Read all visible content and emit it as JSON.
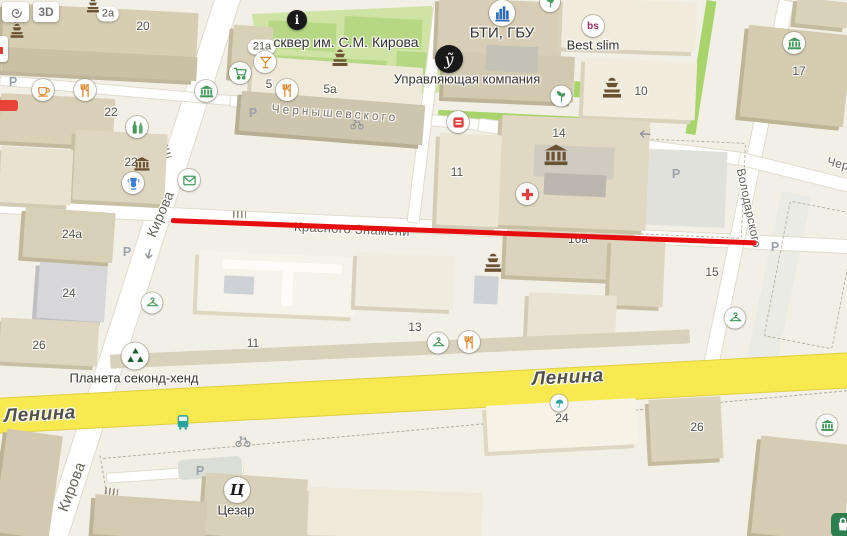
{
  "controls": {
    "tilt_label": "3D",
    "layers_icon": "layers-spiral-icon"
  },
  "colors": {
    "route": "#e60d0d",
    "road_highlight": "#f7e94f",
    "map_background": "#f2efe6"
  },
  "overlay": {
    "route_line": {
      "x": 171,
      "y": 217.5,
      "length": 586,
      "angle_deg": 2.2,
      "color": "#e60d0d"
    }
  },
  "streets": [
    {
      "text": "Кирова",
      "x": 160,
      "y": 214,
      "rot": -67,
      "size": 14
    },
    {
      "text": "Кирова",
      "x": 72,
      "y": 487,
      "rot": -69,
      "size": 15
    },
    {
      "text": "Красного Знамени",
      "x": 352,
      "y": 229,
      "rot": 2.5,
      "size": 13
    },
    {
      "text": "Ленина",
      "x": 40,
      "y": 415,
      "rot": -3,
      "size": 19,
      "major": true
    },
    {
      "text": "Ленина",
      "x": 568,
      "y": 378,
      "rot": -3,
      "size": 19,
      "major": true
    },
    {
      "text": "Володарского",
      "x": 749,
      "y": 208,
      "rot": 78,
      "size": 12
    },
    {
      "text": "Чернышевского",
      "x": 872,
      "y": 172,
      "rot": 14,
      "size": 12
    },
    {
      "text": "Чернышевского",
      "x": 335,
      "y": 113,
      "rot": 4,
      "size": 12,
      "spaced": true
    }
  ],
  "places": [
    {
      "text": "сквер им. С.М. Кирова",
      "x": 346,
      "y": 42,
      "size": 14
    },
    {
      "text": "БТИ, ГБУ",
      "x": 502,
      "y": 33,
      "size": 15
    },
    {
      "text": "Управляющая компания",
      "x": 467,
      "y": 79,
      "size": 13
    },
    {
      "text": "Best slim",
      "x": 593,
      "y": 45,
      "size": 13
    },
    {
      "text": "Планета секонд-хенд",
      "x": 134,
      "y": 378,
      "size": 13
    },
    {
      "text": "Цезар",
      "x": 236,
      "y": 510,
      "size": 13
    }
  ],
  "house_numbers": [
    {
      "text": "2a",
      "x": 108,
      "y": 14,
      "pill": true
    },
    {
      "text": "20",
      "x": 143,
      "y": 26
    },
    {
      "text": "21a",
      "x": 262,
      "y": 47,
      "pill": true
    },
    {
      "text": "5",
      "x": 269,
      "y": 84
    },
    {
      "text": "5a",
      "x": 330,
      "y": 89
    },
    {
      "text": "22",
      "x": 111,
      "y": 112
    },
    {
      "text": "22",
      "x": 131,
      "y": 162
    },
    {
      "text": "10",
      "x": 641,
      "y": 91
    },
    {
      "text": "17",
      "x": 799,
      "y": 71
    },
    {
      "text": "14",
      "x": 559,
      "y": 133
    },
    {
      "text": "11",
      "x": 457,
      "y": 172
    },
    {
      "text": "24a",
      "x": 72,
      "y": 234
    },
    {
      "text": "24",
      "x": 69,
      "y": 293
    },
    {
      "text": "26",
      "x": 39,
      "y": 345
    },
    {
      "text": "16a",
      "x": 578,
      "y": 239
    },
    {
      "text": "15",
      "x": 712,
      "y": 272
    },
    {
      "text": "13",
      "x": 415,
      "y": 327
    },
    {
      "text": "11",
      "x": 253,
      "y": 343
    },
    {
      "text": "24",
      "x": 562,
      "y": 418
    },
    {
      "text": "26",
      "x": 697,
      "y": 427
    }
  ],
  "parking": {
    "label": "Р",
    "positions": [
      [
        13,
        82
      ],
      [
        253,
        113
      ],
      [
        127,
        252
      ],
      [
        676,
        174
      ],
      [
        775,
        247
      ],
      [
        200,
        471
      ]
    ]
  },
  "markers": [
    {
      "name": "info-icon",
      "icon": "text",
      "text": "i",
      "x": 297,
      "y": 20,
      "badge": "black",
      "size": 20,
      "cls": "t-info"
    },
    {
      "name": "fountain-icon",
      "icon": "fountain",
      "x": 340,
      "y": 58,
      "badge": "none",
      "size": 20,
      "color": "brown"
    },
    {
      "name": "fountain-icon",
      "icon": "fountain",
      "x": 93,
      "y": 6,
      "badge": "none",
      "size": 16,
      "color": "brown"
    },
    {
      "name": "fountain-icon",
      "icon": "fountain",
      "x": 17,
      "y": 31,
      "badge": "none",
      "size": 17,
      "color": "brown"
    },
    {
      "name": "bar-icon",
      "icon": "cocktail",
      "x": 265,
      "y": 62,
      "badge": "white",
      "size": 22,
      "color": "orange"
    },
    {
      "name": "supermarket-icon",
      "icon": "cart",
      "x": 240,
      "y": 73,
      "badge": "white",
      "size": 22,
      "color": "green"
    },
    {
      "name": "restaurant-icon",
      "icon": "restaurant",
      "x": 287,
      "y": 90,
      "badge": "white",
      "size": 22,
      "color": "orange"
    },
    {
      "name": "cafe-icon",
      "icon": "cafe",
      "x": 43,
      "y": 90,
      "badge": "white",
      "size": 22,
      "color": "orange"
    },
    {
      "name": "restaurant-icon",
      "icon": "restaurant",
      "x": 85,
      "y": 90,
      "badge": "white",
      "size": 22,
      "color": "orange"
    },
    {
      "name": "museum-icon",
      "icon": "museum",
      "x": 206,
      "y": 91,
      "badge": "white",
      "size": 22,
      "color": "green"
    },
    {
      "name": "pharmacy-icon",
      "icon": "flask",
      "x": 137,
      "y": 127,
      "badge": "white",
      "size": 22,
      "color": "green"
    },
    {
      "name": "museum-icon",
      "icon": "museum",
      "x": 142,
      "y": 164,
      "badge": "none",
      "size": 17,
      "color": "brown"
    },
    {
      "name": "museum-vase-icon",
      "icon": "vase",
      "x": 133,
      "y": 183,
      "badge": "white",
      "size": 22,
      "color": "blue"
    },
    {
      "name": "post-icon",
      "icon": "mail",
      "x": 189,
      "y": 180,
      "badge": "white",
      "size": 22,
      "color": "green"
    },
    {
      "name": "bti-logo-icon",
      "icon": "bti",
      "x": 502,
      "y": 13,
      "badge": "white",
      "size": 26,
      "color": "bti"
    },
    {
      "name": "company-logo-icon",
      "icon": "text",
      "text": "ỹ",
      "x": 449,
      "y": 59,
      "badge": "black",
      "size": 28,
      "cls": "t-uscript"
    },
    {
      "name": "best-slim-logo-icon",
      "icon": "text",
      "text": "bs",
      "x": 593,
      "y": 26,
      "badge": "white",
      "size": 22,
      "cls": "t-bs"
    },
    {
      "name": "eco-leaf-icon",
      "icon": "sprout",
      "x": 561,
      "y": 96,
      "badge": "white",
      "size": 21,
      "color": "green"
    },
    {
      "name": "eco-leaf-icon",
      "icon": "sprout",
      "x": 550,
      "y": 2,
      "badge": "white",
      "size": 20,
      "color": "green"
    },
    {
      "name": "fountain-icon",
      "icon": "fountain",
      "x": 612,
      "y": 88,
      "badge": "none",
      "size": 24,
      "color": "brown"
    },
    {
      "name": "museum-icon",
      "icon": "museum",
      "x": 794,
      "y": 43,
      "badge": "white",
      "size": 22,
      "color": "green"
    },
    {
      "name": "shop-kiosk-icon",
      "icon": "kiosk",
      "x": 458,
      "y": 122,
      "badge": "white",
      "size": 22,
      "color": "red"
    },
    {
      "name": "museum-icon",
      "icon": "museum",
      "x": 556,
      "y": 155,
      "badge": "none",
      "size": 26,
      "color": "brown"
    },
    {
      "name": "pharmacy-cross-icon",
      "icon": "medcross",
      "x": 527,
      "y": 194,
      "badge": "white",
      "size": 22,
      "color": "red"
    },
    {
      "name": "oneway-arrow-icon",
      "icon": "arrowdown",
      "x": 149,
      "y": 254,
      "badge": "none",
      "size": 14,
      "color": "gray",
      "rot": 12
    },
    {
      "name": "oneway-arrow-icon",
      "icon": "arrowleft",
      "x": 645,
      "y": 134,
      "badge": "none",
      "size": 14,
      "color": "gray",
      "rot": 4
    },
    {
      "name": "clothes-hanger-icon",
      "icon": "hanger",
      "x": 152,
      "y": 303,
      "badge": "white",
      "size": 21,
      "color": "green"
    },
    {
      "name": "clothes-hanger-icon",
      "icon": "hanger",
      "x": 438,
      "y": 343,
      "badge": "white",
      "size": 21,
      "color": "green"
    },
    {
      "name": "clothes-hanger-icon",
      "icon": "hanger",
      "x": 735,
      "y": 318,
      "badge": "white",
      "size": 21,
      "color": "green"
    },
    {
      "name": "restaurant-icon",
      "icon": "restaurant",
      "x": 469,
      "y": 342,
      "badge": "white",
      "size": 22,
      "color": "orange"
    },
    {
      "name": "secondhand-recycle-icon",
      "icon": "recycle",
      "x": 135,
      "y": 356,
      "badge": "white",
      "size": 27,
      "color": "dgreen"
    },
    {
      "name": "fountain-icon",
      "icon": "fountain",
      "x": 493,
      "y": 263,
      "badge": "none",
      "size": 22,
      "color": "brown"
    },
    {
      "name": "bus-stop-icon",
      "icon": "bus",
      "x": 183,
      "y": 422,
      "badge": "none",
      "size": 17,
      "color": "teal"
    },
    {
      "name": "bike-path-icon",
      "icon": "bicycle",
      "x": 243,
      "y": 441,
      "badge": "none",
      "size": 16,
      "color": "gray"
    },
    {
      "name": "bike-path-icon",
      "icon": "bicycle",
      "x": 357,
      "y": 124,
      "badge": "none",
      "size": 14,
      "color": "gray"
    },
    {
      "name": "umbrella-icon",
      "icon": "umbrella",
      "x": 559,
      "y": 403,
      "badge": "white",
      "size": 17,
      "color": "teal"
    },
    {
      "name": "museum-icon",
      "icon": "museum",
      "x": 827,
      "y": 425,
      "badge": "white",
      "size": 21,
      "color": "green"
    },
    {
      "name": "cezar-logo-icon",
      "icon": "text",
      "text": "Ц",
      "x": 237,
      "y": 490,
      "badge": "white",
      "size": 26,
      "cls": "t-cezar"
    },
    {
      "name": "shop-partial-icon",
      "icon": "shopgreen",
      "x": 843,
      "y": 525,
      "badge": "none",
      "size": 24,
      "color": "dgreen"
    }
  ]
}
